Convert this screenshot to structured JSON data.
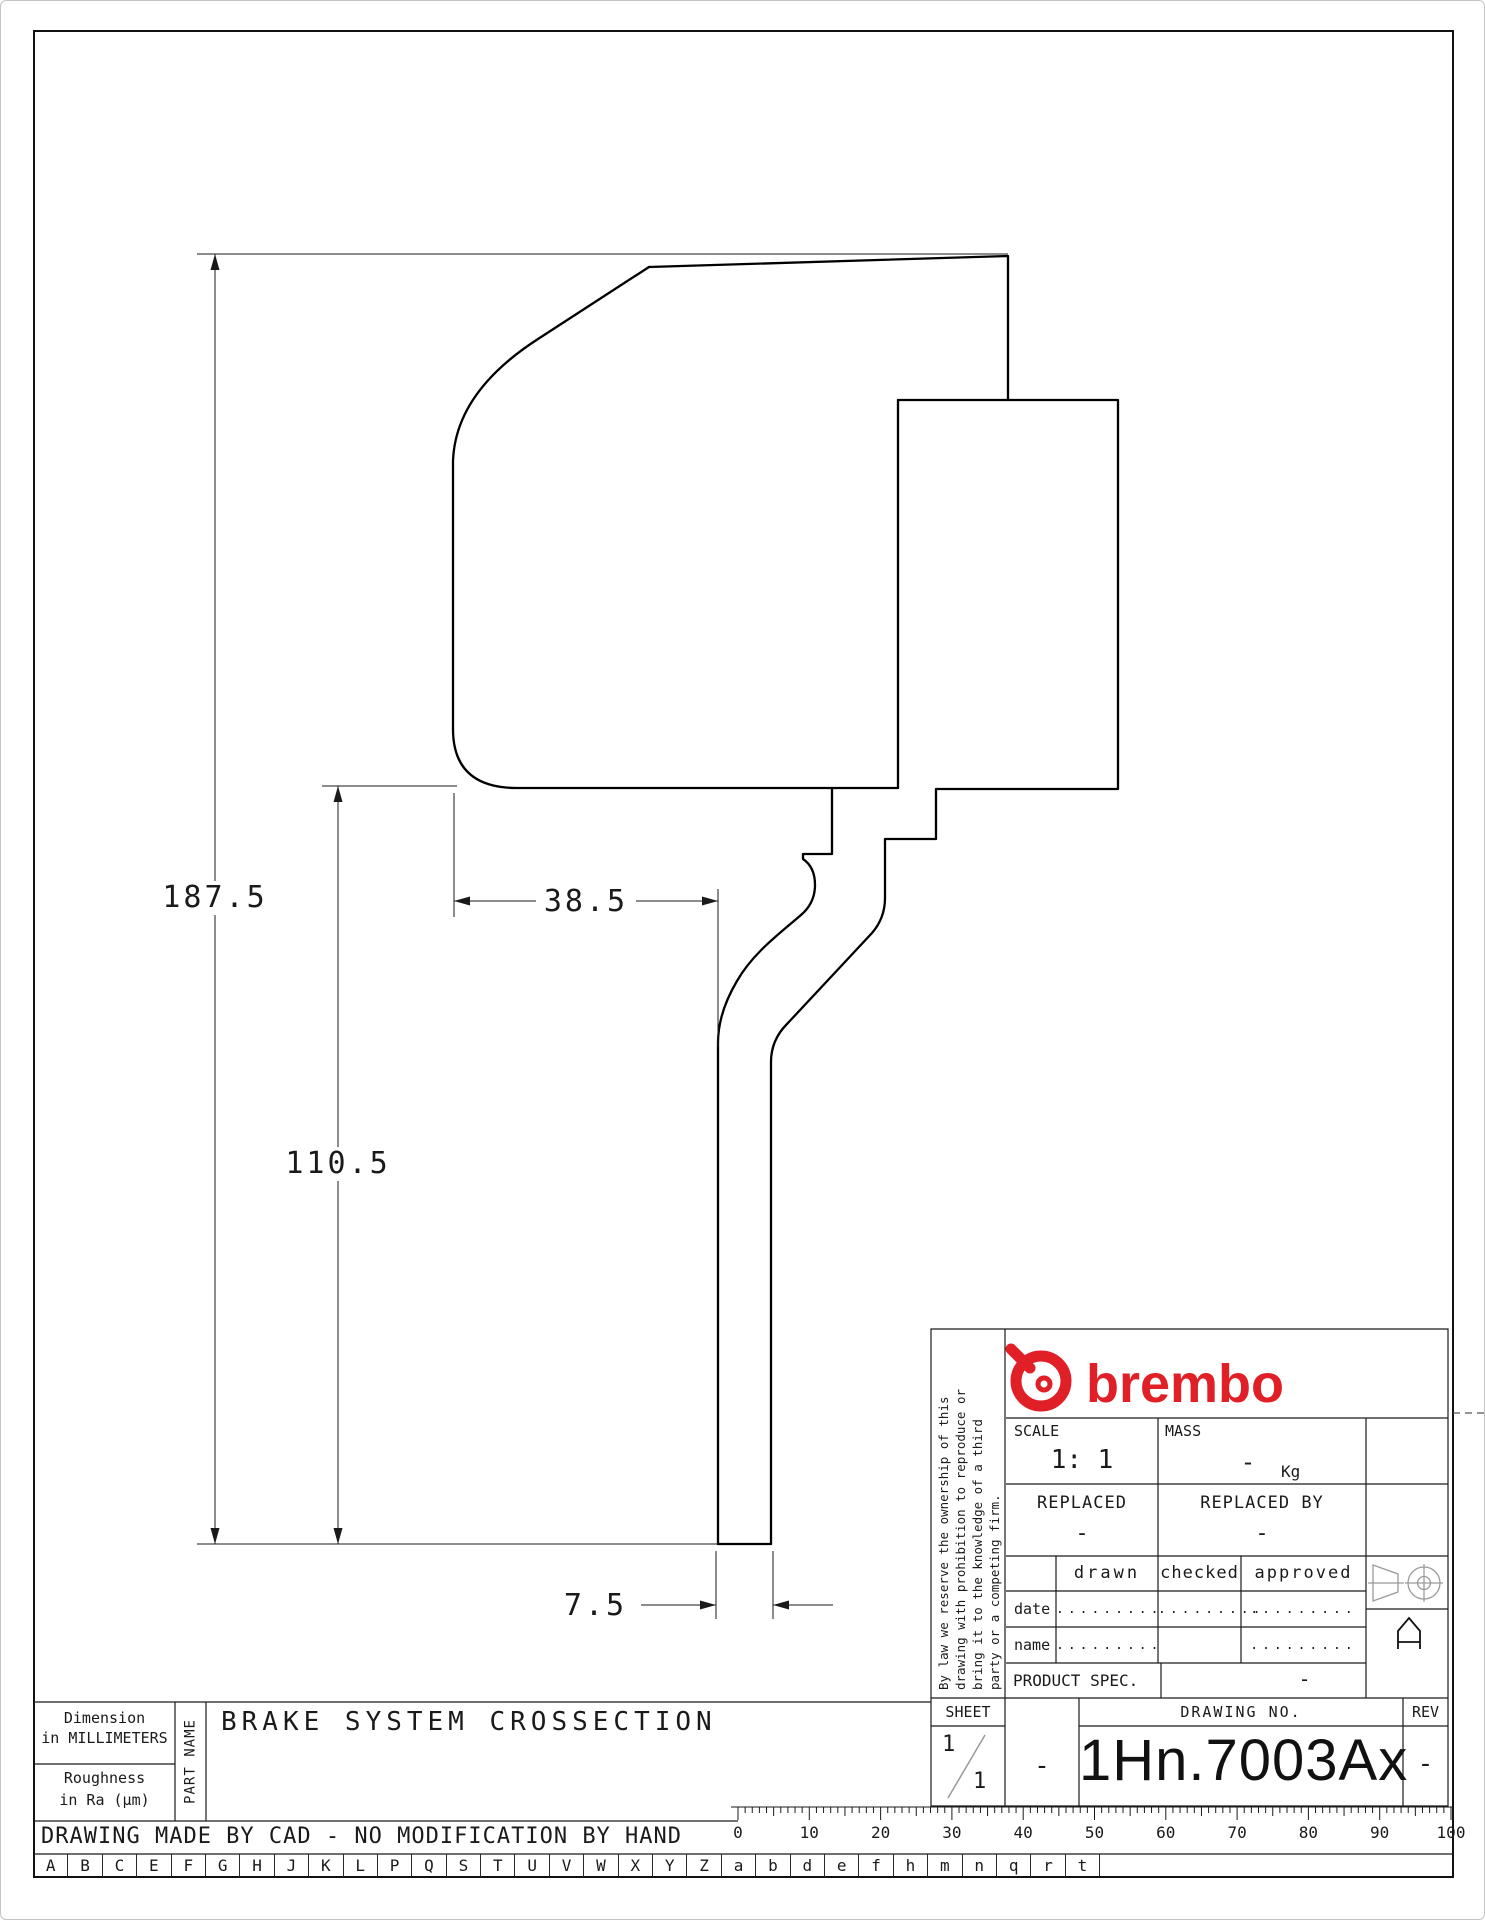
{
  "drawing": {
    "dimensions": {
      "total_height": "187.5",
      "body_height": "110.5",
      "body_width": "38.5",
      "disc_thickness": "7.5"
    }
  },
  "title_block": {
    "disclaimer_lines": [
      "By law we reserve the ownership of this",
      "drawing with prohibition to reproduce or",
      "bring it to the knowledge of a third",
      "party or a competing firm."
    ],
    "brand": "brembo",
    "scale": {
      "label": "SCALE",
      "value": "1: 1"
    },
    "mass": {
      "label": "MASS",
      "value": "-",
      "unit": "Kg"
    },
    "replaced": {
      "label": "REPLACED",
      "value": "-"
    },
    "replaced_by": {
      "label": "REPLACED BY",
      "value": "-"
    },
    "sign_cols": {
      "drawn": "drawn",
      "checked": "checked",
      "approved": "approved"
    },
    "sign_rows": {
      "date_label": "date",
      "name_label": "name",
      "date_drawn": ".........",
      "date_checked": ".........",
      "date_approved": ".........",
      "name_drawn": ".........",
      "name_approved": "........."
    },
    "product_spec": {
      "label": "PRODUCT SPEC.",
      "value": "-"
    },
    "sheet": {
      "label": "SHEET",
      "num": "1",
      "total": "1"
    },
    "dash_cell": "-",
    "drawing_no": {
      "label": "DRAWING NO.",
      "value": "1Hn.7003Ax"
    },
    "rev": {
      "label": "REV",
      "value": "-"
    }
  },
  "footer": {
    "dimension_note_line1": "Dimension",
    "dimension_note_line2": "in MILLIMETERS",
    "roughness_line1": "Roughness",
    "roughness_line2": "in Ra (µm)",
    "part_name_label": "PART NAME",
    "part_title": "BRAKE SYSTEM CROSSECTION",
    "cad_note": "DRAWING MADE BY CAD - NO MODIFICATION BY HAND",
    "ruler_numbers": [
      "0",
      "10",
      "20",
      "30",
      "40",
      "50",
      "60",
      "70",
      "80",
      "90",
      "100"
    ],
    "letters": [
      "A",
      "B",
      "C",
      "E",
      "F",
      "G",
      "H",
      "J",
      "K",
      "L",
      "P",
      "Q",
      "S",
      "T",
      "U",
      "V",
      "W",
      "X",
      "Y",
      "Z",
      "a",
      "b",
      "d",
      "e",
      "f",
      "h",
      "m",
      "n",
      "q",
      "r",
      "t"
    ]
  },
  "colors": {
    "brand_red": "#e01f26",
    "line_black": "#1a1a1a"
  }
}
